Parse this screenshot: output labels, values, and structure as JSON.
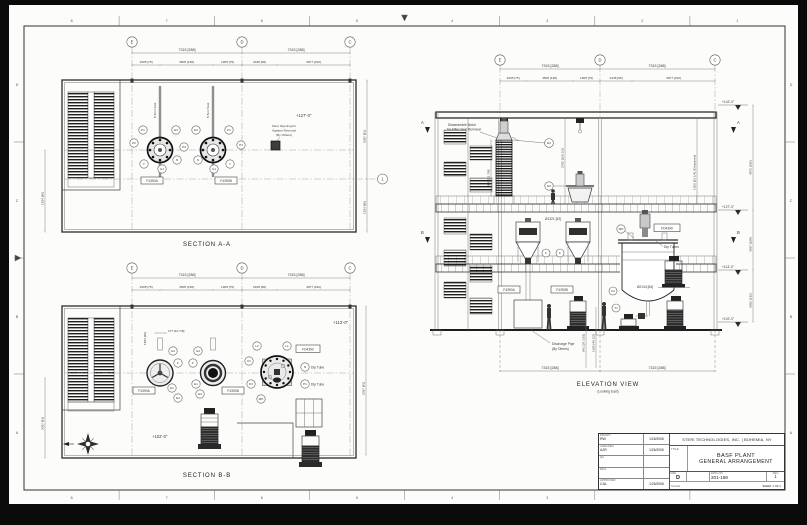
{
  "sheet": {
    "zones_h": [
      "8",
      "7",
      "6",
      "5",
      "4",
      "3",
      "2",
      "1"
    ],
    "zones_v": [
      "D",
      "C",
      "B",
      "A"
    ]
  },
  "grid": {
    "e": "E",
    "d": "D",
    "c": "C",
    "row1": "1"
  },
  "dims": {
    "span": "7315 [288]",
    "bay1": "1905 [75]",
    "bay2": "3505 [138]",
    "bay3": "1905 [75]",
    "bay4": "2438 [96]",
    "bay5": "4877 [192]",
    "aa_right_top": "2057 [81]",
    "aa_right_bot": "1524 [60]",
    "aa_left": "1524 [60]",
    "bb_left": "2057 [81]",
    "bb_right": "2057 [81]",
    "bb_small": "277 [10 7/8]",
    "bb_vert": "1524 [60]",
    "el_d1": "905 [31 7/8]",
    "el_d2": "2782 [109 1/2]",
    "el_clear": "1302 [51 1/4] (Clearance)",
    "el_r_top": "4572 [180]",
    "el_r_mid": "4267 [168]",
    "el_r_bot": "3352 [132]",
    "el_dia1": "Ø1321 [52]",
    "el_dia2": "Ø2134 [84]",
    "el_b1": "941 [37 1/16]",
    "el_b2": "1180 [46 1/2]"
  },
  "levels": {
    "roof": "+142'-0\"",
    "upper": "+127'-0\"",
    "mezz": "+113'-0\"",
    "grade": "+102'-0\""
  },
  "views": {
    "aa": {
      "title": "SECTION A-A",
      "hoist": "5 Ton Hoist",
      "note_l1": "Floor Opening for",
      "note_l2": "Agitator Removal",
      "note_l3": "(By Others)"
    },
    "bb": {
      "title": "SECTION B-B",
      "dip_tube": "Dip Tube"
    },
    "el": {
      "title": "ELEVATION VIEW",
      "subtitle": "(Looking East)",
      "note1_l1": "Disassemble Motor",
      "note1_l2": "for Filter Seal Removal",
      "note2_l1": "Discharge Pipe",
      "note2_l2": "(By Others)",
      "dip_tubes": "Dip Tubes"
    }
  },
  "equipment": {
    "filter_a": "F4390A",
    "filter_b": "F4390B",
    "reactor": "FD4390"
  },
  "tags": {
    "p1": "P1",
    "p2": "P2",
    "p3": "P3",
    "e1": "E1",
    "e3": "E3",
    "e4": "E4",
    "f": "F",
    "g1": "G1",
    "g2": "G2",
    "n": "N",
    "t": "T",
    "l1": "L1",
    "l2": "L2",
    "k1": "K1",
    "k3": "K3",
    "mh": "MH",
    "f2": "F2",
    "t1": "T1",
    "a": "A",
    "b": "B"
  },
  "title_block": {
    "company": "STERI TECHNOLOGIES, INC. | BOHEMIA, NY",
    "title_label": "TITLE",
    "title_line1": "BASF PLANT",
    "title_line2": "GENERAL ARRANGEMENT",
    "rows": [
      {
        "label": "DRAWN",
        "name": "RW",
        "date": "1/26/2006"
      },
      {
        "label": "CHECKED",
        "name": "AJR",
        "date": "1/26/2006"
      },
      {
        "label": "QA",
        "name": "",
        "date": ""
      },
      {
        "label": "MFG",
        "name": "",
        "date": ""
      },
      {
        "label": "APPROVED",
        "name": "CAL",
        "date": "1/26/2006"
      }
    ],
    "size_label": "SIZE",
    "size": "D",
    "dwg_label": "DWG NO.",
    "dwg_no": "201-169",
    "rev_label": "REV",
    "rev": "1",
    "scale_label": "SCALE",
    "sheet_text": "SHEET 1 OF 1"
  }
}
